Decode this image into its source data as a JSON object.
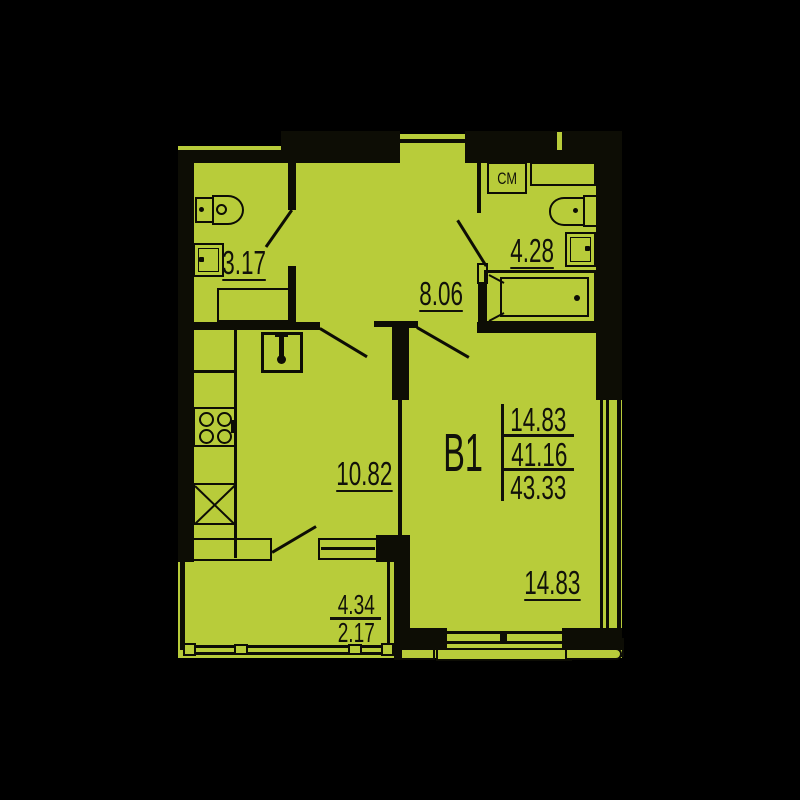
{
  "plan": {
    "apartment_id": "В1",
    "summary": {
      "living_area": "14.83",
      "area": "41.16",
      "total_area": "43.33"
    },
    "rooms": {
      "wc_area": "3.17",
      "hallway_area": "8.06",
      "bathroom_area": "4.28",
      "kitchen_area": "10.82",
      "living_room_area": "14.83",
      "balcony_area_full": "4.34",
      "balcony_area_reduced": "2.17"
    },
    "labels": {
      "washing_machine": "СМ"
    },
    "colors": {
      "fill": "#b8cc3a",
      "background": "#000000",
      "line": "#0d0d05"
    }
  }
}
